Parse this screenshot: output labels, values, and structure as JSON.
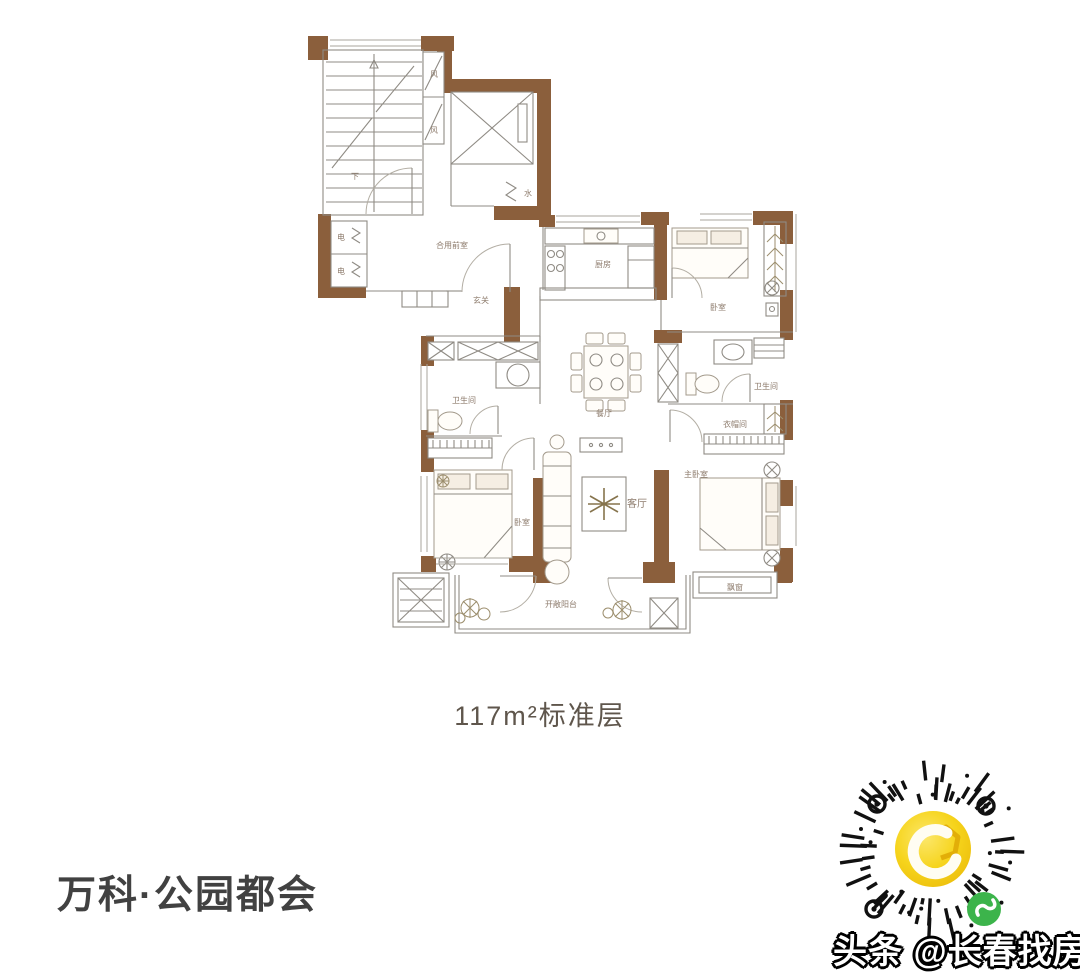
{
  "plan": {
    "caption": "117m²标准层",
    "labels": {
      "stairs_down": "下",
      "vent_top": "风",
      "vent_bottom": "风",
      "elec_top": "电",
      "elec_bottom": "电",
      "water": "水",
      "shared_lobby": "合用前室",
      "entry": "玄关",
      "kitchen": "厨房",
      "bedroom_top": "卧室",
      "bath_right": "卫生间",
      "closet": "衣帽间",
      "dining": "餐厅",
      "bath_left": "卫生间",
      "bedroom_left": "卧室",
      "living": "客厅",
      "master_bedroom": "主卧室",
      "bay_window": "飘窗",
      "balcony": "开敞阳台"
    }
  },
  "footer": {
    "project_title": "万科·公园都会",
    "watermark": "头条 @长春找房豹"
  },
  "colors": {
    "wall_brown": "#8b5f3c",
    "qr_yellow": "#f6d41c",
    "qr_green": "#3cb44b"
  }
}
